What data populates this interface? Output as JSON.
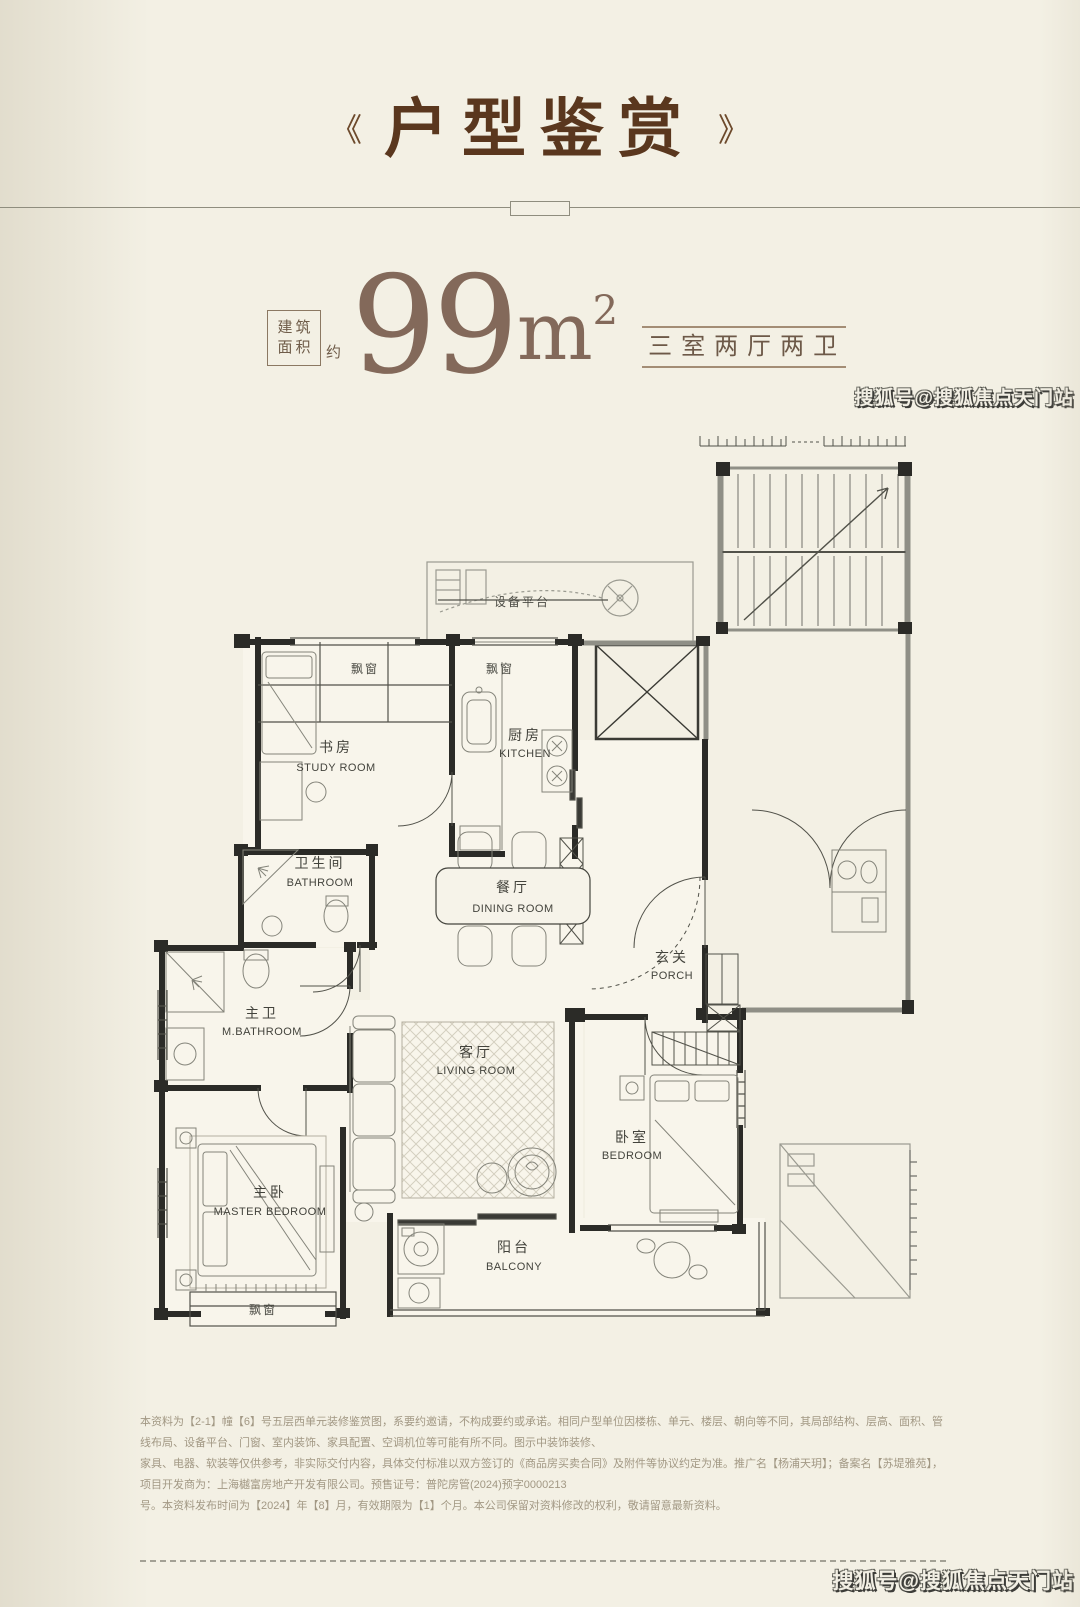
{
  "header": {
    "left_bracket": "《",
    "title": "户型鉴赏",
    "right_bracket": "》"
  },
  "headline": {
    "area_label_line1": "建筑",
    "area_label_line2": "面积",
    "approx": "约",
    "area_value": "99",
    "area_unit": "m",
    "area_sup": "2",
    "layout": "三室两厅两卫"
  },
  "watermark": {
    "text": "搜狐号@搜狐焦点天门站"
  },
  "floorplan": {
    "annotations": {
      "equipment_platform": "设备平台",
      "bay_window": "飘窗"
    },
    "rooms": [
      {
        "id": "study",
        "cn": "书房",
        "en": "STUDY ROOM"
      },
      {
        "id": "kitchen",
        "cn": "厨房",
        "en": "KITCHEN"
      },
      {
        "id": "bathroom",
        "cn": "卫生间",
        "en": "BATHROOM"
      },
      {
        "id": "dining",
        "cn": "餐厅",
        "en": "DINING ROOM"
      },
      {
        "id": "master-bathroom",
        "cn": "主卫",
        "en": "M.BATHROOM"
      },
      {
        "id": "porch",
        "cn": "玄关",
        "en": "PORCH"
      },
      {
        "id": "living",
        "cn": "客厅",
        "en": "LIVING ROOM"
      },
      {
        "id": "bedroom",
        "cn": "卧室",
        "en": "BEDROOM"
      },
      {
        "id": "master-bedroom",
        "cn": "主卧",
        "en": "MASTER BEDROOM"
      },
      {
        "id": "balcony",
        "cn": "阳台",
        "en": "BALCONY"
      }
    ]
  },
  "disclaimer": {
    "lines": [
      "本资料为【2-1】幢【6】号五层西单元装修鉴赏图，系要约邀请，不构成要约或承诺。相同户型单位因楼栋、单元、楼层、朝向等不同，其局部结构、层高、面积、管线布局、设备平台、门窗、室内装饰、家具配置、空调机位等可能有所不同。图示中装饰装修、",
      "家具、电器、软装等仅供参考，非实际交付内容，具体交付标准以双方签订的《商品房买卖合同》及附件等协议约定为准。推广名【杨浦天玥】；备案名【苏堤雅苑】，项目开发商为：上海樾富房地产开发有限公司。预售证号：普陀房管(2024)预字0000213",
      "号。本资料发布时间为【2024】年【8】月，有效期限为【1】个月。本公司保留对资料修改的权利，敬请留意最新资料。"
    ]
  }
}
